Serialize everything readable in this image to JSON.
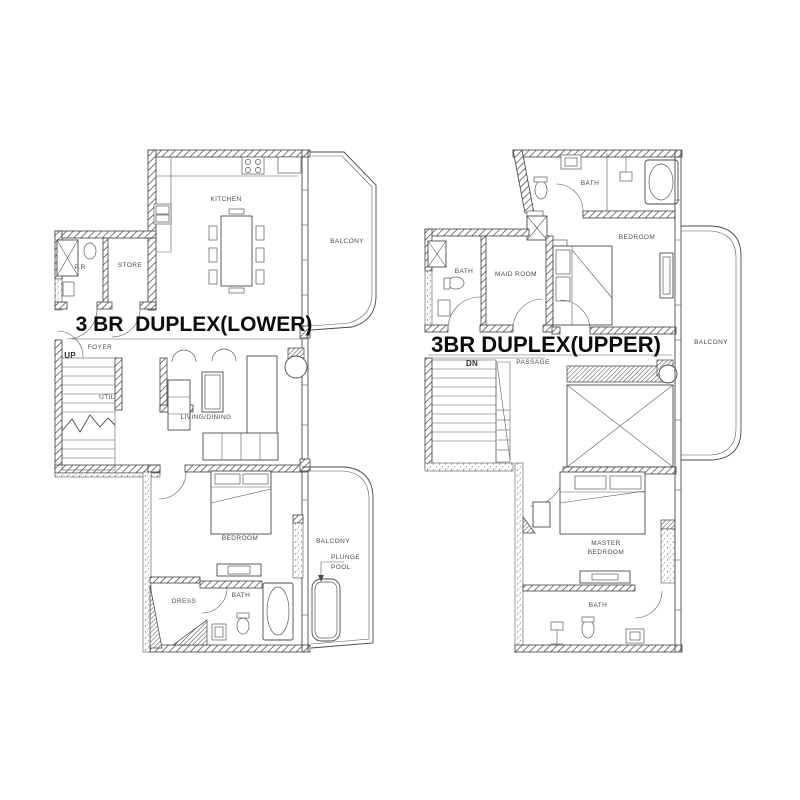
{
  "document": {
    "type": "architectural-floor-plan",
    "background_color": "#ffffff",
    "line_color": "#4a4a4a",
    "title_color": "#0c0c0c"
  },
  "lower_plan": {
    "title": "3 BR  DUPLEX(LOWER)",
    "labels": {
      "kitchen": "KITCHEN",
      "balcony_upper": "BALCONY",
      "pr": "P.R",
      "store": "STORE",
      "foyer": "FOYER",
      "up": "UP",
      "util": "UTIL",
      "living_dining": "LIVING/DINING",
      "bedroom": "BEDROOM",
      "balcony_lower": "BALCONY",
      "plunge_line1": "PLUNGE",
      "plunge_line2": "POOL",
      "dress": "DRESS",
      "bath": "BATH"
    }
  },
  "upper_plan": {
    "title": "3BR DUPLEX(UPPER)",
    "labels": {
      "bath_top": "BATH",
      "bedroom": "BEDROOM",
      "bath_left": "BATH",
      "maid_room": "MAID ROOM",
      "balcony": "BALCONY",
      "dn": "DN",
      "passage": "PASSAGE",
      "master_line1": "MASTER",
      "master_line2": "BEDROOM",
      "bath_bottom": "BATH"
    }
  }
}
